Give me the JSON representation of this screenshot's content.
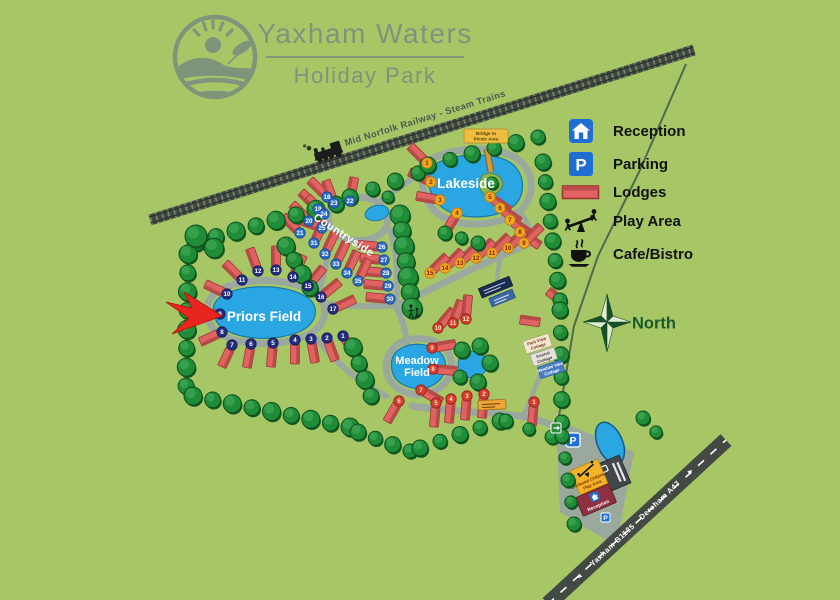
{
  "header": {
    "title": "Yaxham Waters",
    "subtitle": "Holiday Park"
  },
  "legend": {
    "items": [
      {
        "id": "reception",
        "label": "Reception"
      },
      {
        "id": "parking",
        "label": "Parking"
      },
      {
        "id": "lodges",
        "label": "Lodges"
      },
      {
        "id": "play-area",
        "label": "Play Area"
      },
      {
        "id": "cafe",
        "label": "Cafe/Bistro"
      }
    ]
  },
  "railway": {
    "label": "Mid Norfolk Railway - Steam Trains"
  },
  "compass": {
    "label": "North"
  },
  "roads": {
    "west_label": "Yaxham B1135",
    "west_arrow": "◄",
    "east_label": "Dereham A47",
    "east_arrow": "►"
  },
  "areas": {
    "lakeside": {
      "label": "Lakeside"
    },
    "countryside": {
      "label": "Countryside"
    },
    "priors": {
      "label": "Priors Field"
    },
    "meadow": {
      "label_line1": "Meadow",
      "label_line2": "Field"
    }
  },
  "signs": {
    "bridge": {
      "line1": "Bridge to",
      "line2": "Picnic Area"
    },
    "play_area": {
      "line1": "Enclosed Children's",
      "line2": "Play Area"
    },
    "reception_label": "Reception",
    "parking_letter": "P",
    "cottages": [
      {
        "line1": "Park View",
        "line2": "Cottage"
      },
      {
        "line1": "Kennel",
        "line2": "Cottage"
      },
      {
        "line1": "Meadow View",
        "line2": "Cottage"
      }
    ]
  },
  "lodges": {
    "style": {
      "body": "#e06361",
      "ridge": "#b84a48",
      "outline": "#9c3434"
    },
    "groups": {
      "lakeside": {
        "marker_bg": "#f3a81c",
        "marker_fg": "#7c2210",
        "marker_edge": "#bb7d12",
        "items": [
          [
            1,
            427,
            163,
            225
          ],
          [
            2,
            431,
            182,
            205
          ],
          [
            3,
            440,
            200,
            190
          ],
          [
            4,
            457,
            213,
            120
          ],
          [
            5,
            490,
            197,
            35
          ],
          [
            6,
            500,
            208,
            35
          ],
          [
            7,
            510,
            220,
            35
          ],
          [
            8,
            520,
            232,
            35
          ],
          [
            9,
            524,
            243,
            315
          ],
          [
            10,
            508,
            248,
            315
          ],
          [
            11,
            492,
            253,
            315
          ],
          [
            12,
            476,
            258,
            315
          ],
          [
            13,
            460,
            263,
            315
          ],
          [
            14,
            445,
            268,
            315
          ],
          [
            15,
            430,
            273,
            315
          ]
        ]
      },
      "countryside": {
        "marker_bg": "#2e6cc0",
        "marker_fg": "#ffffff",
        "marker_edge": "#1b4a8c",
        "items": [
          [
            18,
            327,
            197,
            225
          ],
          [
            19,
            318,
            209,
            225
          ],
          [
            20,
            309,
            221,
            225
          ],
          [
            21,
            300,
            233,
            225
          ],
          [
            22,
            350,
            201,
            280
          ],
          [
            23,
            334,
            203,
            250
          ],
          [
            24,
            324,
            214,
            225
          ],
          [
            25,
            322,
            228,
            200
          ],
          [
            26,
            382,
            247,
            185
          ],
          [
            27,
            384,
            260,
            185
          ],
          [
            28,
            386,
            273,
            185
          ],
          [
            29,
            388,
            286,
            185
          ],
          [
            30,
            390,
            299,
            185
          ],
          [
            31,
            314,
            243,
            295
          ],
          [
            32,
            325,
            254,
            295
          ],
          [
            33,
            336,
            264,
            295
          ],
          [
            34,
            347,
            273,
            295
          ],
          [
            35,
            358,
            281,
            295
          ]
        ]
      },
      "priors": {
        "marker_bg": "#232e7d",
        "marker_fg": "#ffffff",
        "marker_edge": "#141c55",
        "items": [
          [
            1,
            343,
            336,
            55
          ],
          [
            2,
            327,
            338,
            70
          ],
          [
            3,
            311,
            339,
            80
          ],
          [
            4,
            295,
            340,
            90
          ],
          [
            5,
            273,
            343,
            95
          ],
          [
            6,
            251,
            344,
            100
          ],
          [
            7,
            232,
            345,
            115
          ],
          [
            8,
            222,
            332,
            155
          ],
          [
            9,
            220,
            314,
            180
          ],
          [
            10,
            227,
            294,
            205
          ],
          [
            11,
            242,
            280,
            225
          ],
          [
            12,
            258,
            271,
            250
          ],
          [
            13,
            276,
            270,
            270
          ],
          [
            14,
            293,
            277,
            295
          ],
          [
            15,
            308,
            286,
            310
          ],
          [
            16,
            321,
            297,
            320
          ],
          [
            17,
            333,
            309,
            335
          ]
        ]
      },
      "meadow": {
        "marker_bg": "#d93c32",
        "marker_fg": "#ffedb8",
        "marker_edge": "#8f1f18",
        "items": [
          [
            1,
            534,
            402,
            95
          ],
          [
            2,
            484,
            394,
            95
          ],
          [
            3,
            467,
            396,
            95
          ],
          [
            4,
            451,
            399,
            95
          ],
          [
            5,
            436,
            403,
            95
          ],
          [
            6,
            399,
            401,
            120
          ],
          [
            7,
            421,
            390,
            30
          ],
          [
            8,
            433,
            369,
            5
          ],
          [
            9,
            432,
            348,
            350
          ],
          [
            10,
            438,
            328,
            310
          ],
          [
            11,
            453,
            323,
            290
          ],
          [
            12,
            466,
            319,
            275
          ]
        ]
      }
    },
    "unnumbered": [
      [
        530,
        321,
        8
      ],
      [
        556,
        297,
        38
      ]
    ]
  },
  "colors": {
    "background": "#a7c767",
    "water": "#2aa6e2",
    "path": "#9aa89e",
    "tree": "#1f8c38",
    "lodge": "#e06361",
    "legend_blue": "#1f6ed4",
    "reception_building": "#8e3040",
    "play_area_yellow": "#f2b426",
    "road": "#434a44",
    "railway": "#3f473f",
    "accent_sage": "#7e947b",
    "north_green": "#1c5a2d",
    "marker_navy": "#232e7d",
    "marker_blue": "#2e6cc0",
    "marker_yellow": "#f3a81c",
    "marker_red": "#d93c32"
  }
}
